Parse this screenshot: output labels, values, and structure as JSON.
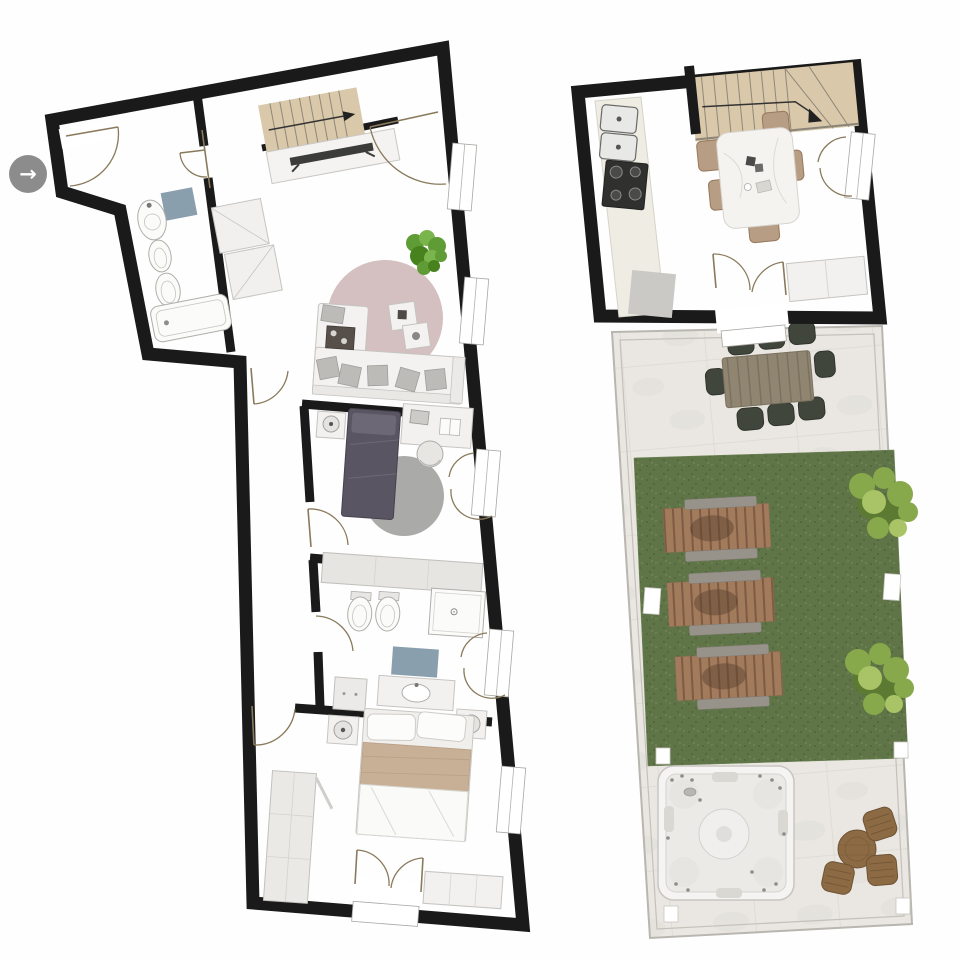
{
  "image": {
    "description": "Photorealistic top-down floor plan of a two-storey apartment, no text labels",
    "background": "#ffffff"
  },
  "carousel": {
    "next_arrow_glyph": "→"
  },
  "colors": {
    "wall": "#1a1a1a",
    "wood": "#d0bc9c",
    "wood_grain": "#bda687",
    "stone": "#eae7e2",
    "stone_line": "#dcd8d2",
    "grass": "#5f7548",
    "grass_dark": "#54683f",
    "counter": "#efece3",
    "rug_pink": "#cfb9ba",
    "rug_gray": "#9b9b99",
    "mat_blue": "#7f97a7",
    "bed_dark": "#5a5562",
    "blanket_tan": "#c8b096",
    "stairs": "#d9c8aa",
    "door_arc": "#8a7a5c",
    "chair_tan": "#b79d84",
    "chair_dark": "#41463d",
    "table_wood": "#8f8571",
    "lounger_wood": "#a27a5c",
    "lounger_frame": "#97928a",
    "wood_table_round": "#8b6a44",
    "bush": "#87a84b",
    "bush_dark": "#5d7a33",
    "plant": "#5f9c35",
    "arrow_bg": "#8c8c8c",
    "arrow_fg": "#ffffff"
  },
  "floor_plans": [
    {
      "name": "lower-floor",
      "rooms": [
        "entrance-hall",
        "bathroom",
        "living-room",
        "corridor",
        "bedroom",
        "shower-room",
        "master-bedroom"
      ],
      "objects": [
        "staircase",
        "tv-sideboard",
        "wardrobe-cabinets",
        "potted-plant",
        "round-rug-pink",
        "corner-sofa",
        "coffee-tables",
        "washbasin",
        "bidet",
        "toilet",
        "bathtub",
        "bath-mat",
        "single-bed",
        "desk",
        "desk-chair",
        "round-rug-gray",
        "shower",
        "vanity-unit",
        "double-bed",
        "nightstands",
        "table-lamps",
        "wardrobe",
        "dresser",
        "french-doors",
        "windows"
      ]
    },
    {
      "name": "upper-floor-with-terrace",
      "rooms": [
        "kitchen-dining",
        "terrace",
        "lawn"
      ],
      "objects": [
        "staircase",
        "kitchen-counter",
        "double-sink",
        "cooktop",
        "dining-table",
        "dining-chairs",
        "sideboard",
        "french-door",
        "outdoor-dining-table",
        "outdoor-chairs",
        "sun-loungers",
        "bushes",
        "hot-tub",
        "round-side-table",
        "stools"
      ]
    }
  ]
}
